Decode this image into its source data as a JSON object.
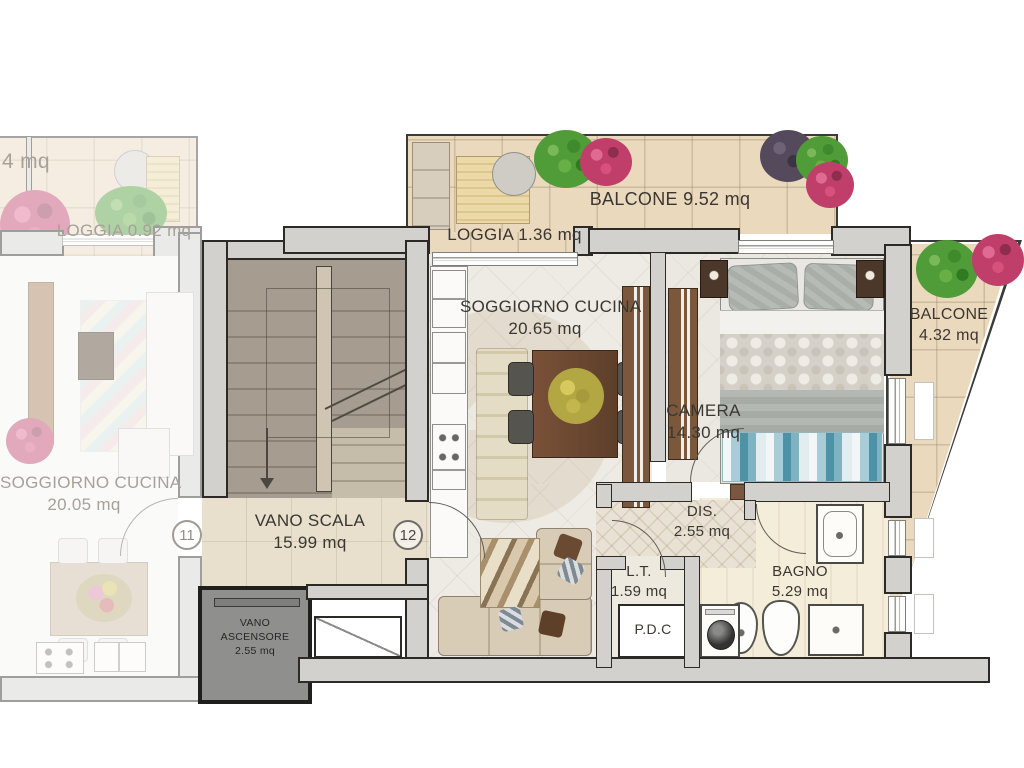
{
  "rooms": {
    "cut_left": {
      "label": "4 mq"
    },
    "loggia_left": {
      "label": "LOGGIA 0.92 mq"
    },
    "soggiorno_left": {
      "name": "SOGGIORNO CUCINA",
      "area": "20.05 mq"
    },
    "balcone_top": {
      "label": "BALCONE 9.52 mq"
    },
    "loggia_top": {
      "label": "LOGGIA 1.36 mq"
    },
    "soggiorno_main": {
      "name": "SOGGIORNO CUCINA",
      "area": "20.65 mq"
    },
    "camera": {
      "name": "CAMERA",
      "area": "14.30 mq"
    },
    "balcone_right": {
      "name": "BALCONE",
      "area": "4.32 mq"
    },
    "vano_scala": {
      "name": "VANO SCALA",
      "area": "15.99 mq"
    },
    "vano_ascensore": {
      "line1": "VANO",
      "line2": "ASCENSORE",
      "line3": "2.55 mq"
    },
    "dis": {
      "name": "DIS.",
      "area": "2.55 mq"
    },
    "lt": {
      "name": "L.T.",
      "area": "1.59 mq"
    },
    "pdc": {
      "label": "P.D.C"
    },
    "bagno": {
      "name": "BAGNO",
      "area": "5.29 mq"
    }
  },
  "units": {
    "left": "11",
    "right": "12"
  },
  "colors": {
    "wall_fill": "#d2d1ce",
    "wall_line": "#2b2a27",
    "balcony_tile": "#ead9bd",
    "interior_floor": "#edebe4",
    "stair_floor": "#a69d90",
    "landing_floor": "#e8dfcc",
    "elevator_fill": "#8f8f8d",
    "label_dark": "#3a3733",
    "label_faded": "#a7a19a",
    "wood_brown": "#6e4b33",
    "bed_throw_teal": "#4d92a6",
    "plant_green": "#4f9c38",
    "plant_pink": "#bf3f6a"
  }
}
